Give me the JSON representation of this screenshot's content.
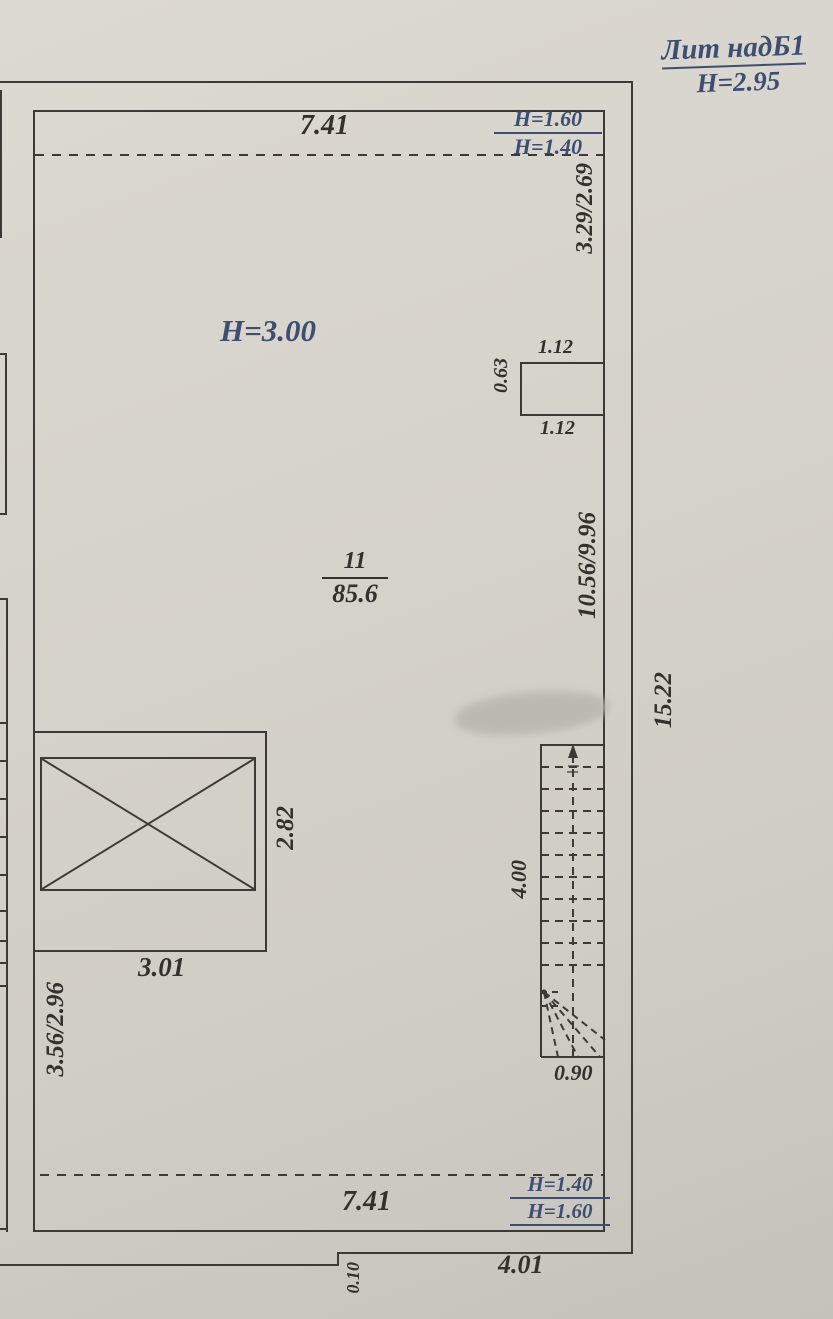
{
  "title": {
    "liter": "Лит надБ1",
    "height": "H=2.95"
  },
  "room": {
    "number": "11",
    "area": "85.6",
    "height": "H=3.00"
  },
  "dimensions": {
    "top_width": "7.41",
    "top_height_upper": "H=1.60",
    "top_height_lower": "H=1.40",
    "right_upper": "3.29/2.69",
    "ledge_top": "1.12",
    "ledge_depth": "0.63",
    "ledge_bottom": "1.12",
    "right_middle": "10.56/9.96",
    "overall_right": "15.22",
    "bay_depth": "2.82",
    "bay_width": "3.01",
    "left_lower": "3.56/2.96",
    "stair_run": "4.00",
    "stair_width": "0.90",
    "bottom_width": "7.41",
    "bottom_height_upper": "H=1.40",
    "bottom_height_lower": "H=1.60",
    "bottom_right_width": "4.01",
    "bottom_step": "0.10"
  },
  "colors": {
    "paper": "#d6d3cb",
    "line": "#3b3a36",
    "pencil": "#32312d",
    "ink": "#3e4d72"
  }
}
